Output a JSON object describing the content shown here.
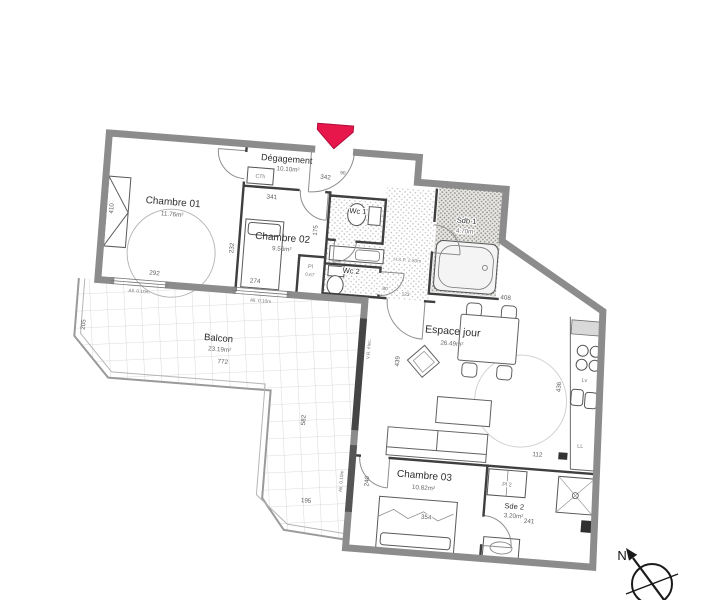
{
  "rooms": {
    "degagement": {
      "name": "Dégagement",
      "area": "10.10m²"
    },
    "chambre01": {
      "name": "Chambre 01",
      "area": "11.76m²"
    },
    "chambre02": {
      "name": "Chambre 02",
      "area": "9.56m²"
    },
    "wc1": {
      "name": "Wc 1"
    },
    "wc2": {
      "name": "Wc 2"
    },
    "sdb1": {
      "name": "Sdb 1",
      "area": "4.70m²"
    },
    "espace_jour": {
      "name": "Espace jour",
      "area": "26.49m²"
    },
    "chambre03": {
      "name": "Chambre 03",
      "area": "10.82m²"
    },
    "sde2": {
      "name": "Sde 2",
      "area": "3.20m²"
    },
    "balcon": {
      "name": "Balcon",
      "area": "23.19m²"
    },
    "placard1": {
      "name": "Pl",
      "size": "0.67"
    },
    "placard2": {
      "name": "Pl 2"
    }
  },
  "dims": {
    "d341": "341",
    "d342": "342",
    "d90": "90",
    "d175": "175",
    "d410": "410",
    "d292": "292",
    "d274": "274",
    "d232": "232",
    "d123": "123",
    "d80": "80",
    "d772": "772",
    "d205": "205",
    "d582": "582",
    "d195": "195",
    "d240": "240",
    "d354": "354",
    "d241": "241",
    "d112": "112",
    "d439": "439",
    "d436": "436",
    "d408": "408"
  },
  "annotations": {
    "hsp": "H.S.P. 2.50m",
    "all010_a": "All. 0.10m",
    "all010_b": "All. 0.10m",
    "alt010": "Alt. 0.10m",
    "vr_elec": "V.R. élec.",
    "cth": "CTh",
    "lv": "Lv",
    "ll": "LL"
  },
  "compass": {
    "north": "N"
  },
  "colors": {
    "entrance_arrow": "#e8174b",
    "exterior_wall": "#8c8c8c",
    "interior_wall": "#3f3f3f"
  }
}
